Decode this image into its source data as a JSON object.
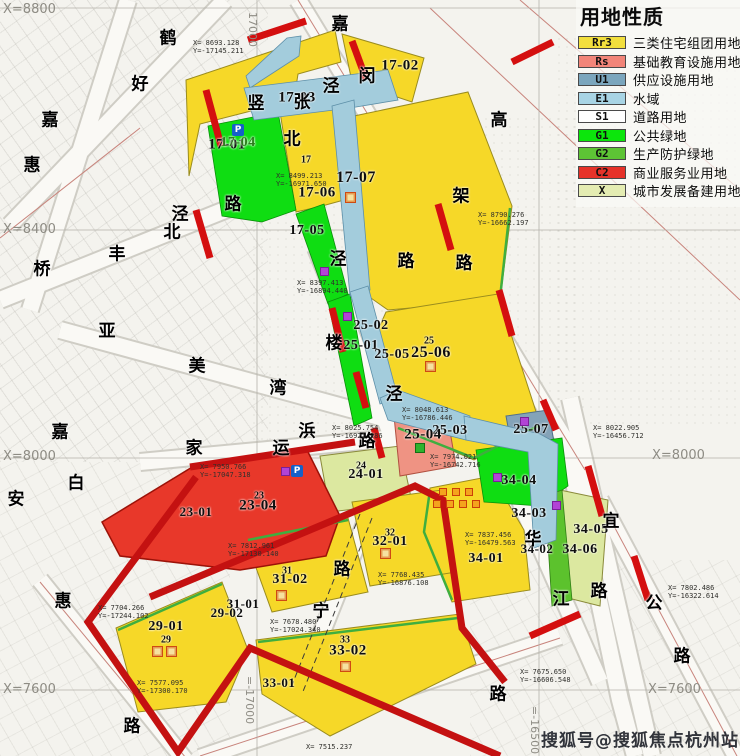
{
  "legend": {
    "title": "用地性质",
    "items": [
      {
        "code": "Rr3",
        "label": "三类住宅组团用地",
        "color": "#f2df3d"
      },
      {
        "code": "Rs",
        "label": "基础教育设施用地",
        "color": "#f28579"
      },
      {
        "code": "U1",
        "label": "供应设施用地",
        "color": "#7ba6bd"
      },
      {
        "code": "E1",
        "label": "水域",
        "color": "#a8d4e4"
      },
      {
        "code": "S1",
        "label": "道路用地",
        "color": "#ffffff"
      },
      {
        "code": "G1",
        "label": "公共绿地",
        "color": "#0ce60c"
      },
      {
        "code": "G2",
        "label": "生产防护绿地",
        "color": "#5dc435"
      },
      {
        "code": "C2",
        "label": "商业服务业用地",
        "color": "#e63229"
      },
      {
        "code": "X",
        "label": "城市发展备建用地",
        "color": "#e4ecb2"
      }
    ]
  },
  "watermark": "搜狐号@搜狐焦点杭州站",
  "icons": {
    "parking": "P"
  },
  "plotLabels": [
    "17-01",
    "17-02",
    "17-03",
    "17-04",
    "17-05",
    "17",
    "17-06",
    "17-07",
    "25-02",
    "25-01",
    "25-05",
    "25",
    "25-06",
    "25-03",
    "25-04",
    "25-07",
    "24",
    "24-01",
    "23",
    "23-04",
    "23-01",
    "32",
    "32-01",
    "31",
    "31-02",
    "31-01",
    "29-02",
    "29-01",
    "29",
    "33",
    "33-02",
    "33-01",
    "34-04",
    "34-03",
    "34-02",
    "34-01",
    "34-05",
    "34-06"
  ],
  "roadChars": [
    "鹤",
    "好",
    "嘉",
    "惠",
    "泾",
    "北",
    "丰",
    "桥",
    "亚",
    "美",
    "湾",
    "嘉",
    "白",
    "安",
    "惠",
    "路",
    "嘉",
    "闵",
    "高",
    "架",
    "路",
    "路",
    "竖",
    "张",
    "泾",
    "北",
    "路",
    "楼",
    "泾",
    "泾",
    "家",
    "运",
    "路",
    "浜",
    "路",
    "宁",
    "华",
    "江",
    "路",
    "宜",
    "公",
    "路",
    "路"
  ],
  "gridLabels": [
    "X=8800",
    "X=8400",
    "X=8000",
    "X=7600",
    "X=8000",
    "X=7600",
    "17000",
    "=-17000",
    "=-16500"
  ],
  "coordLabels": [
    {
      "l1": "X= 8693.128",
      "l2": "Y=-17145.211"
    },
    {
      "l1": "X= 8499.213",
      "l2": "Y=-16971.650"
    },
    {
      "l1": "X= 8790.276",
      "l2": "Y=-16662.197"
    },
    {
      "l1": "X= 8397.413",
      "l2": "Y=-16894.440"
    },
    {
      "l1": "X= 8048.613",
      "l2": "Y=-16786.446"
    },
    {
      "l1": "X= 8025.754",
      "l2": "Y=-16921.286"
    },
    {
      "l1": "X= 8022.905",
      "l2": "Y=-16456.712"
    },
    {
      "l1": "X= 7974.021",
      "l2": "Y=-16742.716"
    },
    {
      "l1": "X= 7837.456",
      "l2": "Y=-16479.563"
    },
    {
      "l1": "X= 7950.766",
      "l2": "Y=-17047.318"
    },
    {
      "l1": "X= 7812.961",
      "l2": "Y=-17130.140"
    },
    {
      "l1": "X= 7704.266",
      "l2": "Y=-17244.102"
    },
    {
      "l1": "X= 7577.095",
      "l2": "Y=-17300.170"
    },
    {
      "l1": "X= 7802.486",
      "l2": "Y=-16322.614"
    },
    {
      "l1": "X= 7515.237",
      "l2": ""
    },
    {
      "l1": "X= 7675.650",
      "l2": "Y=-16606.548"
    },
    {
      "l1": "X= 7678.480",
      "l2": "Y=-17024.340"
    },
    {
      "l1": "X= 7768.435",
      "l2": "Y=-16876.108"
    }
  ]
}
